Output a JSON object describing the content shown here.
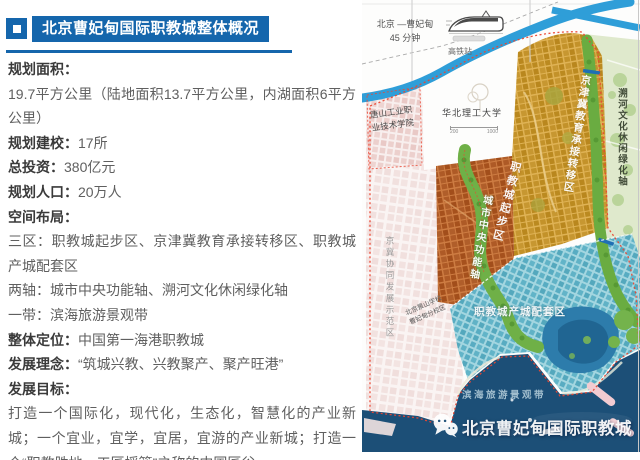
{
  "header": {
    "title": "北京曹妃甸国际职教城整体概况"
  },
  "info": {
    "items": [
      {
        "label": "规划面积：",
        "value": ""
      },
      {
        "label": "",
        "value": "19.7平方公里（陆地面积13.7平方公里，内湖面积6平方公里）"
      },
      {
        "label": "规划建校：",
        "value": "17所"
      },
      {
        "label": "总投资：",
        "value": "380亿元"
      },
      {
        "label": "规划人口：",
        "value": "20万人"
      },
      {
        "label": "空间布局：",
        "value": ""
      },
      {
        "label": "",
        "value": "三区：职教城起步区、京津冀教育承接转移区、职教城产城配套区"
      },
      {
        "label": "",
        "value": "两轴：城市中央功能轴、溯河文化休闲绿化轴"
      },
      {
        "label": "",
        "value": "一带：滨海旅游景观带"
      },
      {
        "label": "整体定位：",
        "value": "中国第一海港职教城"
      },
      {
        "label": "发展理念：",
        "value": "“筑城兴教、兴教聚产、聚产旺港”"
      },
      {
        "label": "发展目标：",
        "value": ""
      },
      {
        "label": "",
        "value": "打造一个国际化，现代化，生态化，智慧化的产业新城；一个宜业，宜学，宜居，宜游的产业新城；打造一个“职教胜地，工匠摇篮”之称的中国匠谷"
      }
    ]
  },
  "map": {
    "transit": {
      "route": "北京 —曹妃甸",
      "time": "45 分钟",
      "station": "高铁站"
    },
    "scale": {
      "min": "200",
      "max": "1000"
    },
    "labels": {
      "tangshan_college": "唐山工业职业技术学院",
      "ncust_university": "华北理工大学",
      "jingji_demo_zone": "京冀协同发展示范区",
      "jjj_transfer_zone": "京津冀教育承接转移区",
      "startup_zone": "职教城起步区",
      "central_axis": "城市中央功能轴",
      "suhe_axis": "溯河文化休闲绿化轴",
      "support_zone": "职教城产城配套区",
      "coastal_belt": "滨海旅游景观带",
      "jingshan_school": "北京景山学校曹妃甸分校区"
    },
    "watermark": {
      "text": "北京曹妃甸国际职教城",
      "icon": "wechat-icon"
    },
    "colors": {
      "accent_blue": "#1566ac",
      "river_blue": "#2f9ed8",
      "sea_navy": "#1c4f77",
      "zone_gold": "#d2a037",
      "zone_red": "#c06a31",
      "zone_teal": "#62b4c8",
      "green_axis": "#6fb047",
      "boundary_red": "#ea4733"
    }
  }
}
